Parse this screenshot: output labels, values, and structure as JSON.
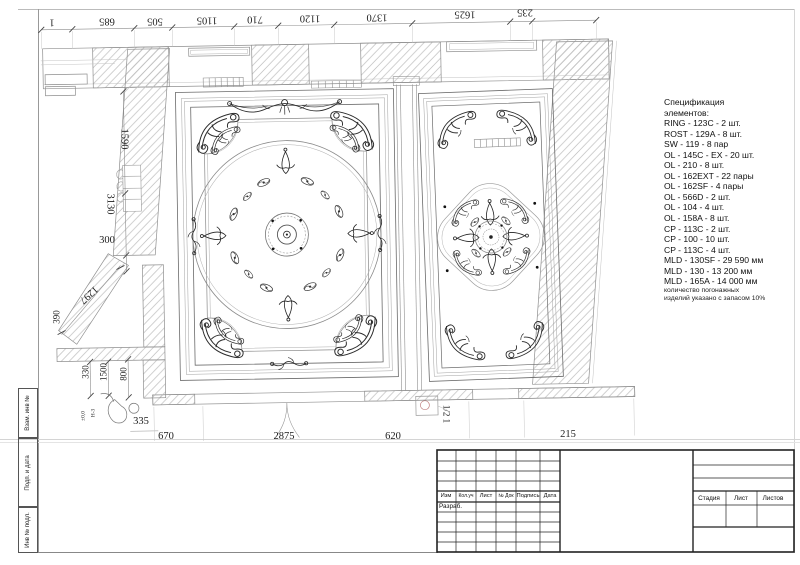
{
  "dimensions": {
    "top": [
      "1",
      "685",
      "505",
      "1105",
      "710",
      "1120",
      "1370",
      "1625",
      "235"
    ],
    "left": [
      "1590",
      "3130",
      "300",
      "1297",
      "390"
    ],
    "lower": [
      "330",
      "1500",
      "800",
      "335"
    ],
    "marks": [
      "±0,0",
      "Н-3"
    ],
    "bottom": [
      "670",
      "2875",
      "620",
      "1/2 1",
      "215"
    ]
  },
  "spec": {
    "title": "Спецификация",
    "subtitle": "элементов:",
    "items": [
      "RING - 123C - 2 шт.",
      "ROST - 129A - 8 шт.",
      "SW - 119 - 8 пар",
      "OL - 145C - EX - 20 шт.",
      "OL - 210 - 8 шт.",
      "OL - 162EXT - 22 пары",
      "OL - 162SF - 4 пары",
      "OL - 566D - 2 шт.",
      "OL - 104 - 4 шт.",
      "OL - 158A - 8 шт.",
      "CP - 113C - 2 шт.",
      "CP - 100 - 10 шт.",
      "CP - 113C - 4 шт.",
      "MLD - 130SF - 29 590 мм",
      "MLD - 130 - 13 200 мм",
      "MLD - 165A - 14 000 мм"
    ],
    "notes": [
      "количество погонажных",
      "изделий указано с запасом 10%"
    ]
  },
  "title_block": {
    "headers": [
      "Изм",
      "Кол.уч",
      "Лист",
      "№ Док",
      "Подпись",
      "Дата"
    ],
    "developer_label": "Разраб.",
    "right_headers": [
      "Стадия",
      "Лист",
      "Листов"
    ]
  },
  "margin": {
    "labels": [
      "Взам. инв №",
      "Подп. и дата",
      "Инв № подл."
    ]
  },
  "colors": {
    "linework": "#2b2b2b",
    "molding": "#8a8a8a",
    "hatch": "#bcbcbc",
    "dim": "#8c8c8c"
  }
}
